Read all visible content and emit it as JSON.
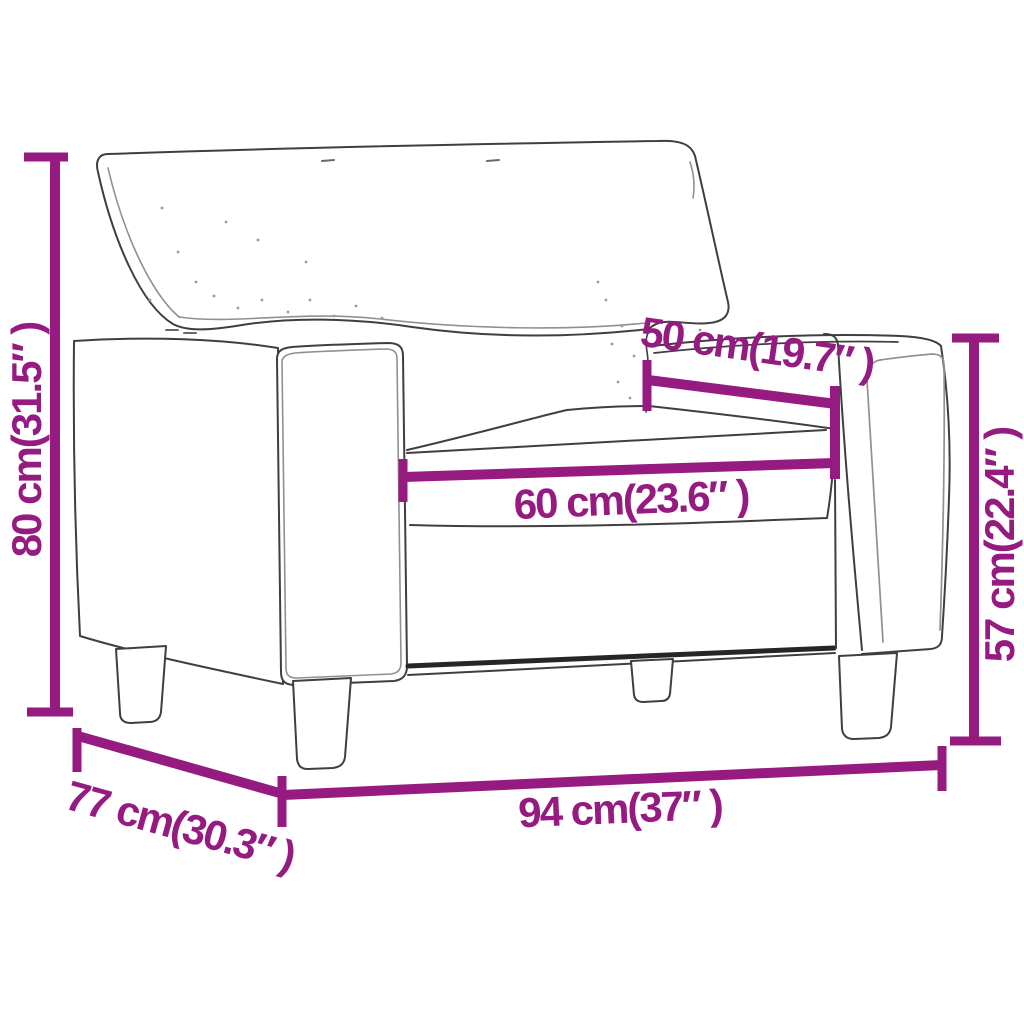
{
  "diagram": {
    "subject": "armchair",
    "description": "line-art armchair with magenta dimension annotations"
  },
  "colors": {
    "background": "#ffffff",
    "dimension": "#951b81",
    "line_art": "#3f3f3f"
  },
  "dimensions": {
    "overall_height": {
      "label": "80 cm(31.5″ )",
      "cm": "80",
      "inches": "31.5",
      "position": "left-vertical"
    },
    "seat_depth": {
      "label": "50 cm(19.7″ )",
      "cm": "50",
      "inches": "19.7",
      "position": "upper-right-diagonal"
    },
    "seat_width": {
      "label": "60 cm(23.6″ )",
      "cm": "60",
      "inches": "23.6",
      "position": "middle-horizontal"
    },
    "arm_height": {
      "label": "57 cm(22.4″ )",
      "cm": "57",
      "inches": "22.4",
      "position": "right-vertical"
    },
    "overall_width": {
      "label": "94 cm(37″ )",
      "cm": "94",
      "inches": "37",
      "position": "bottom-horizontal"
    },
    "overall_depth": {
      "label": "77 cm(30.3″ )",
      "cm": "77",
      "inches": "30.3",
      "position": "bottom-left-diagonal"
    }
  }
}
